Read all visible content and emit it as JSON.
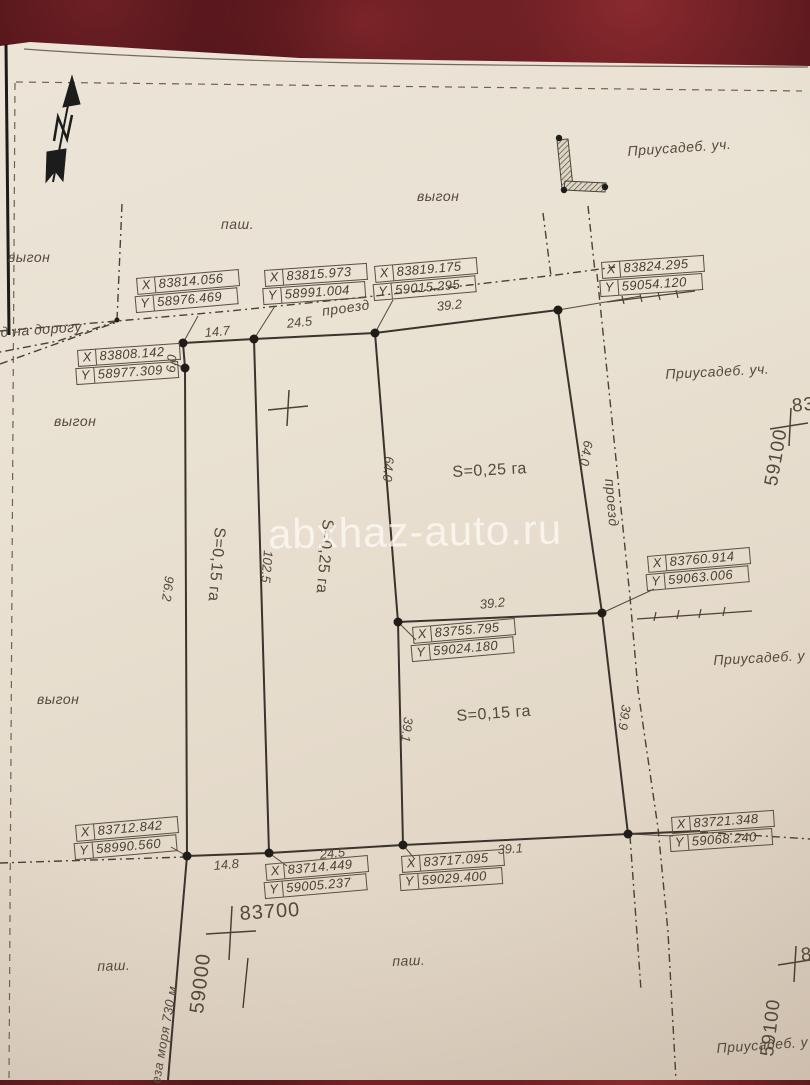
{
  "watermark": "abxhaz-auto.ru",
  "coordinate_box_keys": {
    "x": "X",
    "y": "Y"
  },
  "coordinate_boxes": [
    {
      "id": "top-left-upper",
      "x_value": "83814.056",
      "y_value": "58976.469",
      "left": 136,
      "top": 278,
      "rot": -5
    },
    {
      "id": "top-mid-left",
      "x_value": "83815.973",
      "y_value": "58991.004",
      "left": 264,
      "top": 270,
      "rot": -4
    },
    {
      "id": "top-mid-right",
      "x_value": "83819.175",
      "y_value": "59015.295",
      "left": 374,
      "top": 266,
      "rot": -5
    },
    {
      "id": "top-right",
      "x_value": "83824.295",
      "y_value": "59054.120",
      "left": 601,
      "top": 262,
      "rot": -4
    },
    {
      "id": "left-upper",
      "x_value": "83808.142",
      "y_value": "58977.309",
      "left": 77,
      "top": 350,
      "rot": -4
    },
    {
      "id": "right-mid",
      "x_value": "83760.914",
      "y_value": "59063.006",
      "left": 647,
      "top": 556,
      "rot": -5
    },
    {
      "id": "center",
      "x_value": "83755.795",
      "y_value": "59024.180",
      "left": 412,
      "top": 627,
      "rot": -5
    },
    {
      "id": "bottom-left",
      "x_value": "83712.842",
      "y_value": "58990.560",
      "left": 75,
      "top": 825,
      "rot": -5
    },
    {
      "id": "bottom-mid-left",
      "x_value": "83714.449",
      "y_value": "59005.237",
      "left": 265,
      "top": 864,
      "rot": -5
    },
    {
      "id": "bottom-mid-right",
      "x_value": "83717.095",
      "y_value": "59029.400",
      "left": 401,
      "top": 856,
      "rot": -4
    },
    {
      "id": "bottom-right",
      "x_value": "83721.348",
      "y_value": "59068.240",
      "left": 671,
      "top": 817,
      "rot": -4
    }
  ],
  "land_labels": [
    {
      "text": "выгон",
      "x": 8,
      "y": 249
    },
    {
      "text": "паш.",
      "x": 221,
      "y": 216
    },
    {
      "text": "выгон",
      "x": 417,
      "y": 188
    },
    {
      "text": "Приусадеб. уч.",
      "x": 627,
      "y": 143,
      "rot": -4
    },
    {
      "text": "д на дорогу",
      "x": 0,
      "y": 324,
      "rot": -4
    },
    {
      "text": "проезд",
      "x": 321,
      "y": 303,
      "rot": -8
    },
    {
      "text": "выгон",
      "x": 54,
      "y": 413
    },
    {
      "text": "Приусадеб. уч.",
      "x": 665,
      "y": 366,
      "rot": -3
    },
    {
      "text": "проезд",
      "x": 618,
      "y": 478,
      "rot": 85
    },
    {
      "text": "выгон",
      "x": 37,
      "y": 691
    },
    {
      "text": "Приусадеб. у",
      "x": 713,
      "y": 652,
      "rot": -3
    },
    {
      "text": "паш.",
      "x": 97,
      "y": 958,
      "rot": -2
    },
    {
      "text": "паш.",
      "x": 392,
      "y": 953,
      "rot": -2
    },
    {
      "text": "Приусадеб. у",
      "x": 716,
      "y": 1040,
      "rot": -4
    },
    {
      "text": "еза моря 730 м.",
      "x": 148,
      "y": 1082,
      "rot": -80,
      "size": 13
    }
  ],
  "dimension_labels": [
    {
      "text": "14.7",
      "x": 204,
      "y": 325,
      "rot": -5
    },
    {
      "text": "24.5",
      "x": 286,
      "y": 316,
      "rot": -6
    },
    {
      "text": "39.2",
      "x": 436,
      "y": 299,
      "rot": -6
    },
    {
      "text": "6.0",
      "x": 163,
      "y": 372,
      "rot": -85
    },
    {
      "text": "96.2",
      "x": 177,
      "y": 577,
      "rot": 97
    },
    {
      "text": "102.5",
      "x": 276,
      "y": 551,
      "rot": 95
    },
    {
      "text": "64.0",
      "x": 397,
      "y": 457,
      "rot": 95
    },
    {
      "text": "64.0",
      "x": 596,
      "y": 442,
      "rot": 100
    },
    {
      "text": "39.2",
      "x": 479,
      "y": 597,
      "rot": -6
    },
    {
      "text": "39.1",
      "x": 416,
      "y": 718,
      "rot": 97
    },
    {
      "text": "39.9",
      "x": 634,
      "y": 706,
      "rot": 99
    },
    {
      "text": "14.8",
      "x": 213,
      "y": 858,
      "rot": -5
    },
    {
      "text": "24.5",
      "x": 319,
      "y": 847,
      "rot": -6
    },
    {
      "text": "39.1",
      "x": 497,
      "y": 842,
      "rot": -4
    }
  ],
  "area_labels": [
    {
      "text": "S=0,15 га",
      "x": 228,
      "y": 528,
      "rot": 95
    },
    {
      "text": "S=0,25 га",
      "x": 336,
      "y": 520,
      "rot": 95
    },
    {
      "text": "S=0,25 га",
      "x": 452,
      "y": 464,
      "rot": -3
    },
    {
      "text": "S=0,15 га",
      "x": 456,
      "y": 708,
      "rot": -4
    }
  ],
  "grid_labels": [
    {
      "text": "83700",
      "x": 239,
      "y": 903,
      "rot": -4
    },
    {
      "text": "59000",
      "x": 186,
      "y": 1012,
      "rot": -83
    },
    {
      "text": "59100",
      "x": 761,
      "y": 484,
      "rot": -80,
      "size": 19
    },
    {
      "text": "83",
      "x": 791,
      "y": 396,
      "rot": -6,
      "size": 19
    },
    {
      "text": "59100",
      "x": 757,
      "y": 1055,
      "rot": -83,
      "size": 19
    },
    {
      "text": "8",
      "x": 800,
      "y": 945,
      "rot": -5,
      "size": 19
    }
  ]
}
